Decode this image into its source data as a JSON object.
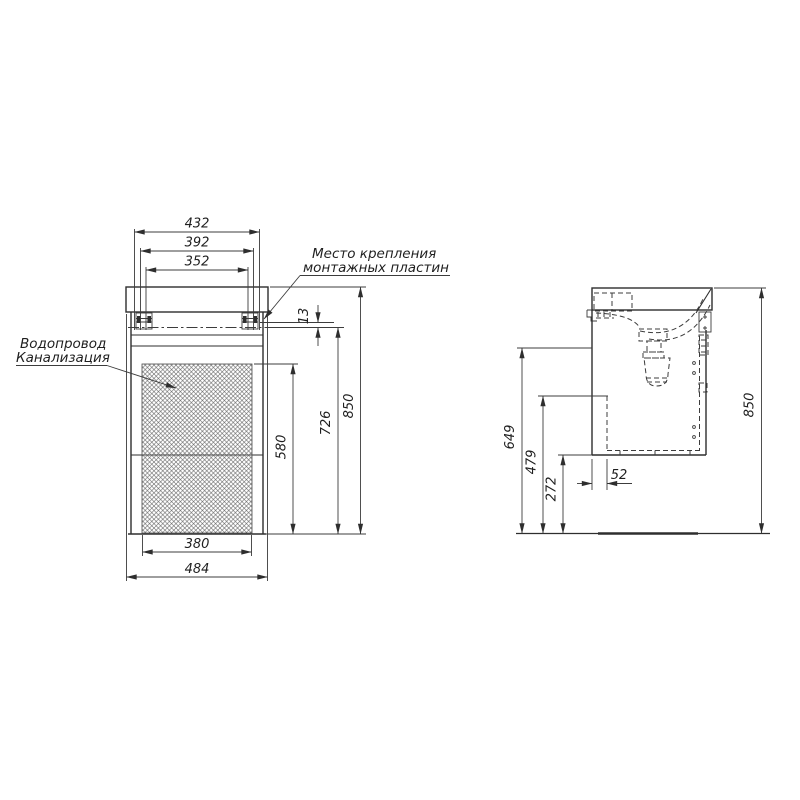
{
  "meta": {
    "background": "#ffffff",
    "line_color": "#2e2e2e",
    "hatch_color": "#5a5a5a"
  },
  "front": {
    "top_dims": [
      "432",
      "392",
      "352"
    ],
    "dim_13": "13",
    "dim_580": "580",
    "dim_726": "726",
    "dim_850": "850",
    "dim_380": "380",
    "dim_484": "484",
    "label_mounting_1": "Место крепления",
    "label_mounting_2": "монтажных пластин",
    "label_plumbing_1": "Водопровод",
    "label_plumbing_2": "Канализация"
  },
  "side": {
    "dim_649": "649",
    "dim_479": "479",
    "dim_272": "272",
    "dim_52": "52",
    "dim_850": "850"
  }
}
